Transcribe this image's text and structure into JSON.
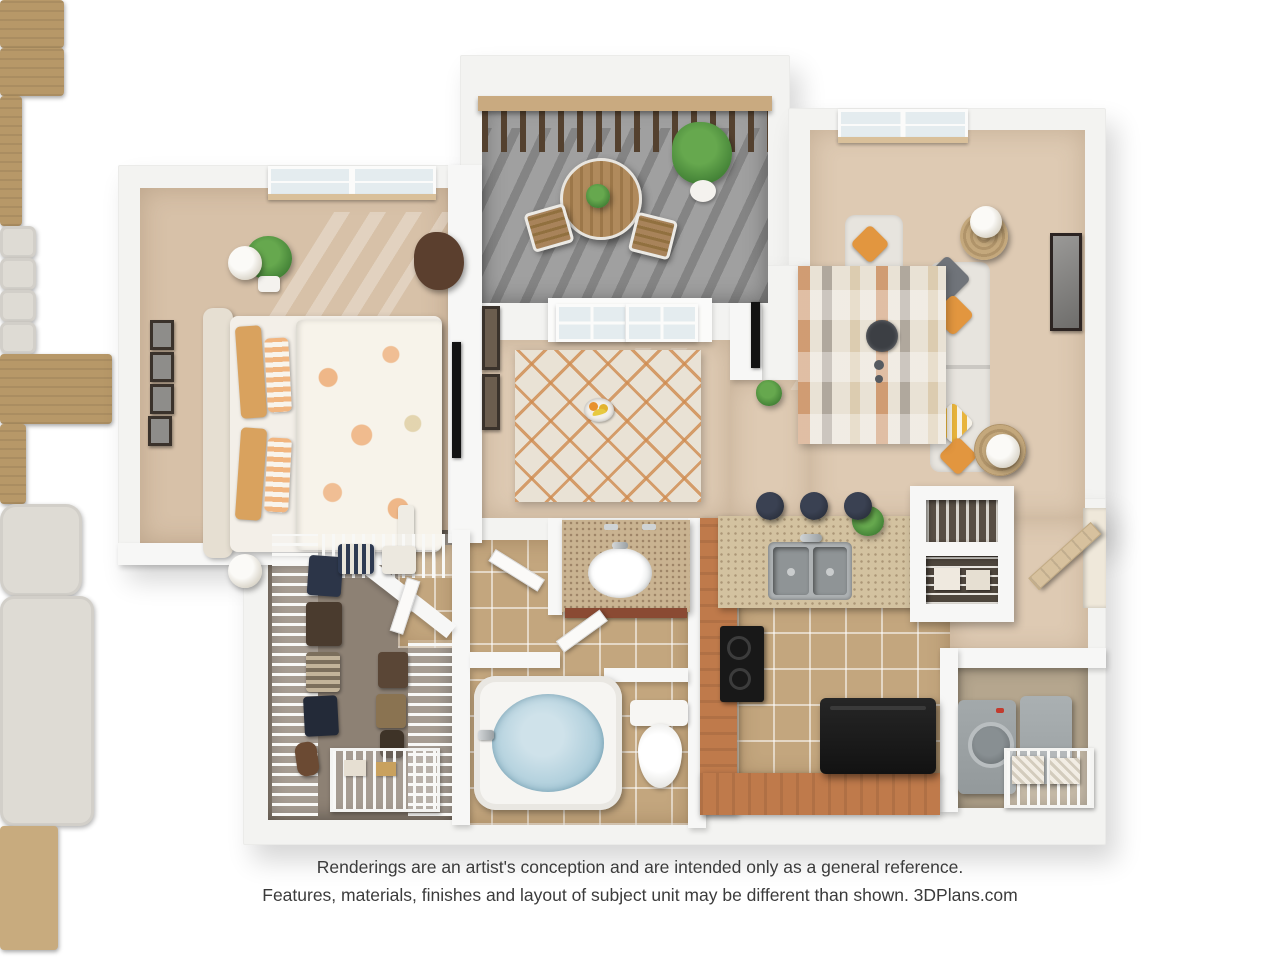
{
  "disclaimer": {
    "line1": "Renderings are an artist's conception and are intended only as a general reference.",
    "line2": "Features, materials, finishes and layout of subject unit may be different than shown. 3DPlans.com"
  },
  "colors": {
    "wall": "#f3f3f1",
    "wall_light": "#f7f7f6",
    "carpet": "#decab3",
    "carpet_bed": "#d7c1a8",
    "balcony_floor": "#a0a0a0",
    "tile": "#c3a67e",
    "closet_floor": "#8d8174",
    "laundry_floor": "#b5a68e",
    "terracotta": "#bf7a4b",
    "granite": "#d3c2a0",
    "granite_vanity": "#c9b391",
    "wood": "#b79868",
    "rail_wood": "#c9aa80",
    "rail_dark": "#54412f",
    "fabric": "#dedbd4",
    "orange": "#e2963f",
    "gray_pillow": "#70747a",
    "water": "#a9cbd9",
    "appliance_black": "#181818",
    "appliance_gray": "#93999b",
    "green": "#3e7c33",
    "green_light": "#66a84e",
    "rug_cream": "#e9e2d5",
    "rug_orange": "#cf8a4e",
    "glass": "#e4ecef",
    "frame": "#3a322b",
    "text": "#3b3b3b"
  },
  "scene": {
    "type": "3d-floor-plan-rendering",
    "rooms": [
      {
        "name": "bedroom",
        "items": [
          "bed with floral comforter",
          "striped pillows",
          "headboard",
          "nightstand (2)",
          "table lamp (2)",
          "gallery wall frames (4)",
          "potted plant",
          "accent chair",
          "tv console",
          "window with blinds"
        ]
      },
      {
        "name": "balcony",
        "items": [
          "wood railing",
          "bistro table",
          "bistro chair (2)",
          "potted palm",
          "concrete floor"
        ]
      },
      {
        "name": "living-room",
        "items": [
          "window with blinds",
          "armchair",
          "sofa",
          "throw pillows",
          "round side table (2)",
          "table lamp (2)",
          "patterned area rug",
          "coffee table with tray",
          "wall art"
        ]
      },
      {
        "name": "dining-area",
        "items": [
          "french doors to balcony",
          "dining table",
          "dining chair (4)",
          "fruit bowl",
          "lattice rug",
          "wall frames (2)",
          "media console with tv"
        ]
      },
      {
        "name": "kitchen",
        "items": [
          "terracotta breakfast bar",
          "bar stool (3)",
          "granite counter",
          "double sink",
          "faucet",
          "cooktop",
          "refrigerator",
          "counter plant",
          "tile floor"
        ]
      },
      {
        "name": "pantry",
        "items": [
          "built-in shelving",
          "storage boxes"
        ]
      },
      {
        "name": "bathroom",
        "items": [
          "granite vanity",
          "oval sink",
          "garden tub",
          "toilet",
          "tile floor",
          "door"
        ]
      },
      {
        "name": "walk-in-closet",
        "items": [
          "wire shelving runs",
          "hanging clothes",
          "shoe baskets",
          "storage bags"
        ]
      },
      {
        "name": "laundry-closet",
        "items": [
          "washer",
          "dryer",
          "wire shelf",
          "laundry baskets"
        ]
      },
      {
        "name": "entry",
        "items": [
          "open front door"
        ]
      }
    ]
  }
}
